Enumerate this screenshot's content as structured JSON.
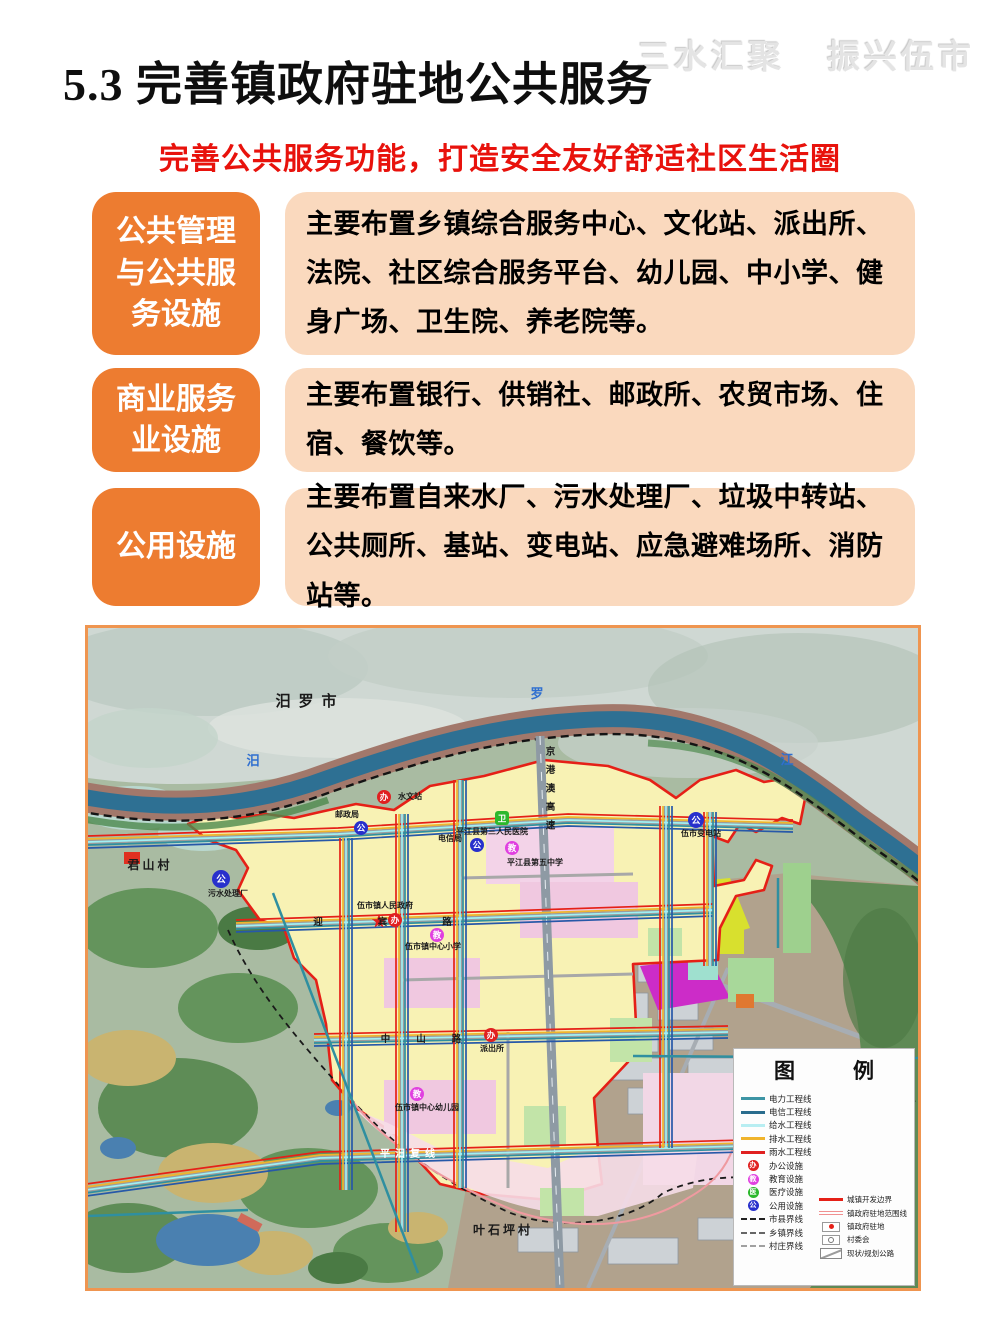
{
  "watermark": {
    "left": "三水汇聚",
    "right": "振兴伍市"
  },
  "title": "5.3 完善镇政府驻地公共服务",
  "subtitle": "完善公共服务功能，打造安全友好舒适社区生活圈",
  "colors": {
    "accent_orange": "#ed7c30",
    "peach": "#fad9be",
    "subtitle_red": "#e8120c",
    "map_border": "#ef9550",
    "boundary_red": "#e52017"
  },
  "rows": [
    {
      "label": "公共管理与公共服务设施",
      "content": "主要布置乡镇综合服务中心、文化站、派出所、法院、社区综合服务平台、幼儿园、中小学、健身广场、卫生院、养老院等。"
    },
    {
      "label": "商业服务业设施",
      "content": "主要布置银行、供销社、邮政所、农贸市场、住宿、餐饮等。"
    },
    {
      "label": "公用设施",
      "content": "主要布置自来水厂、污水处理厂、垃圾中转站、公共厕所、基站、变电站、应急避难场所、消防站等。"
    }
  ],
  "map": {
    "labels": {
      "city": "汨罗市",
      "river1": "汨",
      "river2": "罗",
      "river3": "江",
      "village_w": "君山村",
      "village_s": "叶石坪村",
      "hydro": "水文站",
      "post": "邮政局",
      "telecom": "电信局",
      "hospital": "平江县第三人民医院",
      "school5": "平江县第五中学",
      "gov": "伍市镇人民政府",
      "primary": "伍市镇中心小学",
      "kindergarten": "伍市镇中心幼儿园",
      "police": "派出所",
      "sewage": "污水处理厂",
      "substation": "伍市变电站",
      "road_pingmi": "平汨复线",
      "road_zhongshan": "中山路",
      "road_yingbin": "迎宾路",
      "road_expwy": "京港澳高速"
    },
    "icon_chars": {
      "office": "办",
      "edu": "教",
      "medical": "卫",
      "utility": "公"
    },
    "legend": {
      "title_left": "图",
      "title_right": "例",
      "left": [
        {
          "label": "电力工程线",
          "type": "line",
          "color": "#3d95a5"
        },
        {
          "label": "电信工程线",
          "type": "line",
          "color": "#2a6d8e"
        },
        {
          "label": "给水工程线",
          "type": "line",
          "color": "#b8eef2"
        },
        {
          "label": "排水工程线",
          "type": "line",
          "color": "#f0b42c"
        },
        {
          "label": "雨水工程线",
          "type": "line",
          "color": "#e02020"
        },
        {
          "label": "办公设施",
          "type": "circle",
          "color": "#e02020",
          "char": "办"
        },
        {
          "label": "教育设施",
          "type": "circle",
          "color": "#e040e0",
          "char": "教"
        },
        {
          "label": "医疗设施",
          "type": "circle",
          "color": "#2cb82c",
          "char": "医"
        },
        {
          "label": "公用设施",
          "type": "circle",
          "color": "#2830cc",
          "char": "公"
        },
        {
          "label": "市县界线",
          "type": "dash",
          "color": "#222222"
        },
        {
          "label": "乡镇界线",
          "type": "dash",
          "color": "#666666"
        },
        {
          "label": "村庄界线",
          "type": "dash",
          "color": "#a0a0a0"
        }
      ],
      "right": [
        {
          "label": "城镇开发边界",
          "type": "thickline",
          "color": "#e52017"
        },
        {
          "label": "镇政府驻地范围线",
          "type": "dblline",
          "color": "#f09090"
        },
        {
          "label": "镇政府驻地",
          "type": "dotbox",
          "color": "#e52017"
        },
        {
          "label": "村委会",
          "type": "ringbox",
          "color": "#777777"
        },
        {
          "label": "现状/规划公路",
          "type": "roadbox",
          "color": "#9c9c9c"
        }
      ]
    }
  }
}
